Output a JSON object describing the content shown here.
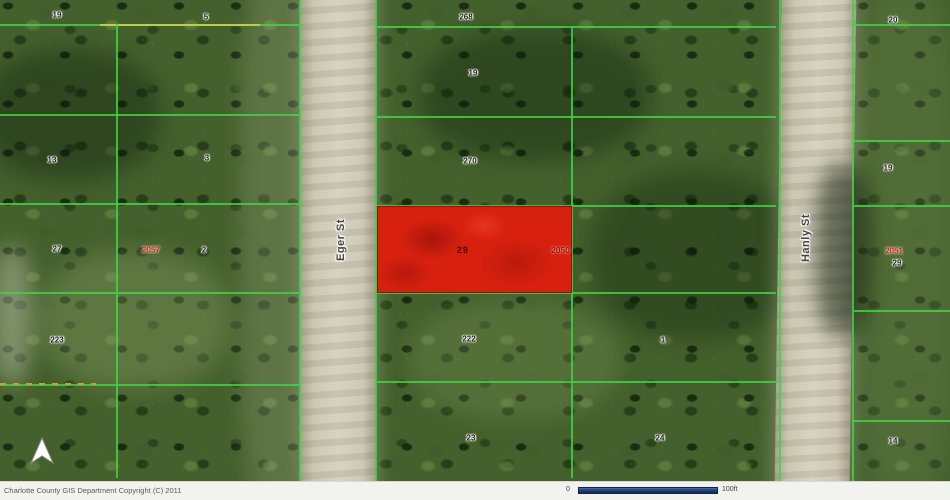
{
  "map": {
    "streets": [
      {
        "name": "Eger St"
      },
      {
        "name": "Hanly St"
      }
    ],
    "highlight_parcel": {
      "lot_number": "29",
      "address": "2050"
    },
    "lot_labels": [
      {
        "text": "19",
        "x": 57,
        "y": 15
      },
      {
        "text": "5",
        "x": 206,
        "y": 17
      },
      {
        "text": "13",
        "x": 52,
        "y": 160
      },
      {
        "text": "3",
        "x": 207,
        "y": 158
      },
      {
        "text": "27",
        "x": 57,
        "y": 249
      },
      {
        "text": "2",
        "x": 204,
        "y": 250
      },
      {
        "text": "223",
        "x": 57,
        "y": 340
      },
      {
        "text": "268",
        "x": 466,
        "y": 17
      },
      {
        "text": "19",
        "x": 473,
        "y": 73
      },
      {
        "text": "270",
        "x": 470,
        "y": 161
      },
      {
        "text": "222",
        "x": 469,
        "y": 339
      },
      {
        "text": "23",
        "x": 471,
        "y": 438
      },
      {
        "text": "1",
        "x": 663,
        "y": 340
      },
      {
        "text": "24",
        "x": 660,
        "y": 438
      },
      {
        "text": "20",
        "x": 893,
        "y": 20
      },
      {
        "text": "19",
        "x": 888,
        "y": 168
      },
      {
        "text": "29",
        "x": 897,
        "y": 263
      },
      {
        "text": "14",
        "x": 893,
        "y": 441
      }
    ],
    "address_labels": [
      {
        "text": "2057",
        "x": 151,
        "y": 250
      },
      {
        "text": "2051",
        "x": 894,
        "y": 251
      }
    ],
    "icons": {
      "north_arrow": "north-arrow"
    }
  },
  "footer": {
    "copyright": "Charlotte County GIS Department Copyright (C) 2011",
    "scale": {
      "zero_label": "0",
      "distance_label": "100ft"
    }
  },
  "colors": {
    "boundary_green": "#3fd245",
    "parcel_highlight": "#d8200f",
    "scalebar_blue": "#24447c"
  }
}
